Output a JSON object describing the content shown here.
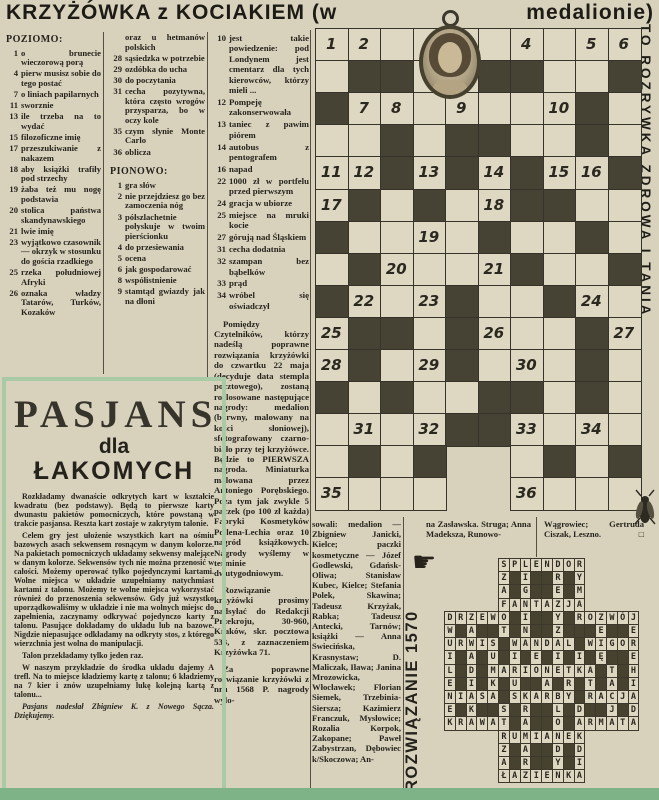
{
  "title": {
    "left": "KRZYŻÓWKA z KOCIAKIEM (w",
    "right": "medalionie)"
  },
  "side_banner": "TO ROZRYWKA ZDROWA I TANIA",
  "clues": {
    "col1": {
      "header": "POZIOMO:",
      "items": [
        {
          "n": "1",
          "t": "o brunecie wieczorową porą"
        },
        {
          "n": "4",
          "t": "pierw musisz sobie do tego postać"
        },
        {
          "n": "7",
          "t": "o liniach papilarnych"
        },
        {
          "n": "11",
          "t": "sworznie"
        },
        {
          "n": "13",
          "t": "ile trzeba na to wydać"
        },
        {
          "n": "15",
          "t": "filozoficzne imię"
        },
        {
          "n": "17",
          "t": "przeszukiwanie z nakazem"
        },
        {
          "n": "18",
          "t": "aby książki trafiły pod strzechy"
        },
        {
          "n": "19",
          "t": "żaba też mu nogę podstawia"
        },
        {
          "n": "20",
          "t": "stolica państwa skandynawskiego"
        },
        {
          "n": "21",
          "t": "lwie imię"
        },
        {
          "n": "23",
          "t": "wyjątkowo czasownik — okrzyk w stosunku do gościa rzadkiego"
        },
        {
          "n": "25",
          "t": "rzeka południowej Afryki"
        },
        {
          "n": "26",
          "t": "oznaka władzy Tatarów, Turków, Kozaków"
        }
      ]
    },
    "col2": {
      "items_a": [
        {
          "n": "",
          "t": "oraz u hetmanów polskich"
        },
        {
          "n": "28",
          "t": "sąsiedzka w potrzebie"
        },
        {
          "n": "29",
          "t": "ozdóbka do ucha"
        },
        {
          "n": "30",
          "t": "do poczytania"
        },
        {
          "n": "31",
          "t": "cecha pozytywna, która często wrogów przysparza, bo w oczy kole"
        },
        {
          "n": "35",
          "t": "czym słynie Monte Carlo"
        },
        {
          "n": "36",
          "t": "oblicza"
        }
      ],
      "header": "PIONOWO:",
      "items_b": [
        {
          "n": "1",
          "t": "gra słów"
        },
        {
          "n": "2",
          "t": "nie przejdziesz go bez zamoczenia nóg"
        },
        {
          "n": "3",
          "t": "półszlachetnie połyskuje w twoim pierścionku"
        },
        {
          "n": "4",
          "t": "do przesiewania"
        },
        {
          "n": "5",
          "t": "ocena"
        },
        {
          "n": "6",
          "t": "jak gospodarować"
        },
        {
          "n": "8",
          "t": "współistnienie"
        },
        {
          "n": "9",
          "t": "stamtąd gwiazdy jak na dłoni"
        }
      ]
    },
    "col3": {
      "items": [
        {
          "n": "10",
          "t": "jest takie powiedzenie: pod Londynem jest cmentarz dla tych kierowców, którzy mieli ..."
        },
        {
          "n": "12",
          "t": "Pompeję zakonserwowała"
        },
        {
          "n": "13",
          "t": "taniec z pawim piórem"
        },
        {
          "n": "14",
          "t": "autobus z pentografem"
        },
        {
          "n": "16",
          "t": "napad"
        },
        {
          "n": "22",
          "t": "1000 zł w portfelu przed pierwszym"
        },
        {
          "n": "24",
          "t": "gracja w ubiorze"
        },
        {
          "n": "25",
          "t": "miejsce na mruki kocie"
        },
        {
          "n": "27",
          "t": "górują nad Śląskiem"
        },
        {
          "n": "31",
          "t": "cecha dodatnia"
        },
        {
          "n": "32",
          "t": "szampan bez bąbelków"
        },
        {
          "n": "33",
          "t": "prąd"
        },
        {
          "n": "34",
          "t": "wróbel się oświadczył"
        }
      ]
    }
  },
  "prizes": {
    "p1": "Pomiędzy Czytelników, którzy nadeślą poprawne rozwiązania krzyżówki do czwartku 22 maja (decyduje data stempla pocztowego), zostaną rozlosowane następujące nagrody: medalion (barwny, malowany na kości słoniowej), sfotografowany czarno-biało przy tej krzyżówce. Będzie to PIERWSZA nagroda. Miniaturka malowana przez Antoniego Porębskiego. Poza tym jak zwykle 5 paczek (po 100 zł każda) Fabryki Kosmetyków Pollena-Lechia oraz 10 nagród książkowych. Nagrody wyślemy w terminie dwutygodniowym.",
    "p2": "Rozwiązanie krzyżówki prosimy nadsyłać do Redakcji Przekroju, 30-960, Kraków, skr. pocztowa 533, z zaznaczeniem Krzyżówka 71.",
    "p3": "Za poprawne rozwiązanie krzyżówki z nru 1568 P. nagrody wylo-"
  },
  "winners": {
    "col1": "sowali: medalion — Zbigniew Janicki, Kielce; paczki kosmetyczne — Józef Godlewski, Gdańsk-Oliwa; Stanisław Kubec, Kielce; Stefania Polek, Skawina; Tadeusz Krzyżak, Rabka; Tadeusz Antecki, Tarnów; książki — Anna Swiecińska, Krasnystaw; D. Maliczak, Iława; Janina Mrozowicka, Włocławek; Florian Siemek, Trzebinia-Siersza; Kazimierz Franczuk, Mysłowice; Rozalia Korpok, Zakopane; Paweł Zabystrzan, Dębowiec k/Skoczowa; An-",
    "col2": "na Zasławska. Struga; Anna Madeksza, Runowo-",
    "col3": "Wągrowiec; Gertruda Ciszak, Leszno.",
    "end_mark": "□"
  },
  "pasjans": {
    "title1": "PASJANS",
    "title2": "dla",
    "title3": "ŁAKOMYCH",
    "p1": "Rozkładamy dwanaście odkrytych kart w kształcie kwadratu (bez podstawy). Będą to pierwsze karty dwunastu pakietów pomocniczych, które powstaną w trakcie pasjansa. Reszta kart zostaje w zakrytym talonie.",
    "p2": "Celem gry jest ułożenie wszystkich kart na ośmiu bazowych asach sekwensem rosnącym w danym kolorze. Na pakietach pomocniczych układamy sekwensy malejące w danym kolorze. Sekwensów tych nie można przenosić w całości. Możemy operować tylko pojedynczymi kartami. Wolne miejsca w układzie uzupełniamy natychmiast kartami z talonu. Możemy te wolne miejsca wykorzystać również do przenoszenia sekwensów. Gdy już wszystko uporządkowaliśmy w układzie i nie ma wolnych miejsc do zapełnienia, zaczynamy odkrywać pojedynczo karty z talonu. Pasujące dokładamy do układu lub na bazowe. Nigdzie niepasujące odkładamy na odkryty stos, z którego wierzchnia jest wolna do manipulacji.",
    "p3": "Talon przekładamy tylko jeden raz.",
    "p4": "W naszym przykładzie do środka układu dajemy A trefl. Na to miejsce kładziemy kartę z talonu; 6 kładziemy na 7 kier i znów uzupełniamy lukę kolejną kartą z talonu...",
    "credit": "Pasjans nadesłał Zbigniew K. z Nowego Sącza. Dziękujemy."
  },
  "solution": {
    "label": "ROZWIĄZANIE 1570",
    "hand_icon": "☛",
    "grid": [
      "     SPLENDOR     ",
      "     Z#I##R#Y     ",
      "     A#G##E#M     ",
      "     FANTAZJA     ",
      "DRZEWO#I##Y#ROZWÓJ",
      "W#A##T#N##Z###E##E",
      "URWIS#WANDAL#WIGOR",
      "I#A#U#I#E#I#I#Ę##E",
      "L#D#MARIONETKA#T#H",
      "E#I#K#U##A#R#T#A#I",
      "NIASA#SKARBY#RACJA",
      "E#K##S#R##L#D##J#D",
      "KRAWAT#A##O#ARMATA",
      "     RUMIANEK     ",
      "     Z#A##D#D     ",
      "     A#R##Y#I     ",
      "     ŁAZIENKA     "
    ]
  },
  "main_grid": {
    "rows": [
      "..........",
      ".##..##..#",
      "#.......#.",
      "..#.##..#.",
      "..#.#.#..#",
      ".#.#..##..",
      "#....#..#.",
      ".#....#..#",
      "#...#..#..",
      ".##.#...#.",
      ".#..#...#.",
      "#.#..##.#.",
      "....##....",
      ".#.#  .#.#",
      "....  ...."
    ],
    "numbers": {
      "1": [
        0,
        0
      ],
      "2": [
        0,
        1
      ],
      "3": [
        0,
        3
      ],
      "4": [
        0,
        6
      ],
      "5": [
        0,
        8
      ],
      "6": [
        0,
        9
      ],
      "7": [
        2,
        1
      ],
      "8": [
        2,
        2
      ],
      "9": [
        2,
        4
      ],
      "10": [
        2,
        7
      ],
      "11": [
        4,
        0
      ],
      "12": [
        4,
        1
      ],
      "13": [
        4,
        3
      ],
      "14": [
        4,
        5
      ],
      "15": [
        4,
        7
      ],
      "16": [
        4,
        8
      ],
      "17": [
        5,
        0
      ],
      "18": [
        5,
        5
      ],
      "19": [
        6,
        3
      ],
      "20": [
        7,
        2
      ],
      "21": [
        7,
        5
      ],
      "22": [
        8,
        1
      ],
      "23": [
        8,
        3
      ],
      "24": [
        8,
        8
      ],
      "25": [
        9,
        0
      ],
      "26": [
        9,
        5
      ],
      "27": [
        9,
        9
      ],
      "28": [
        10,
        0
      ],
      "29": [
        10,
        3
      ],
      "30": [
        10,
        6
      ],
      "31": [
        12,
        1
      ],
      "32": [
        12,
        3
      ],
      "33": [
        12,
        6
      ],
      "34": [
        12,
        8
      ],
      "35": [
        14,
        0
      ],
      "36": [
        14,
        6
      ]
    }
  },
  "colors": {
    "paper": "#d8d2bd",
    "ink": "#26231c",
    "cell_white": "#ded8c2",
    "cell_black": "#474334",
    "green_frame": "#a8caa5",
    "green_bar": "#7eb387"
  }
}
